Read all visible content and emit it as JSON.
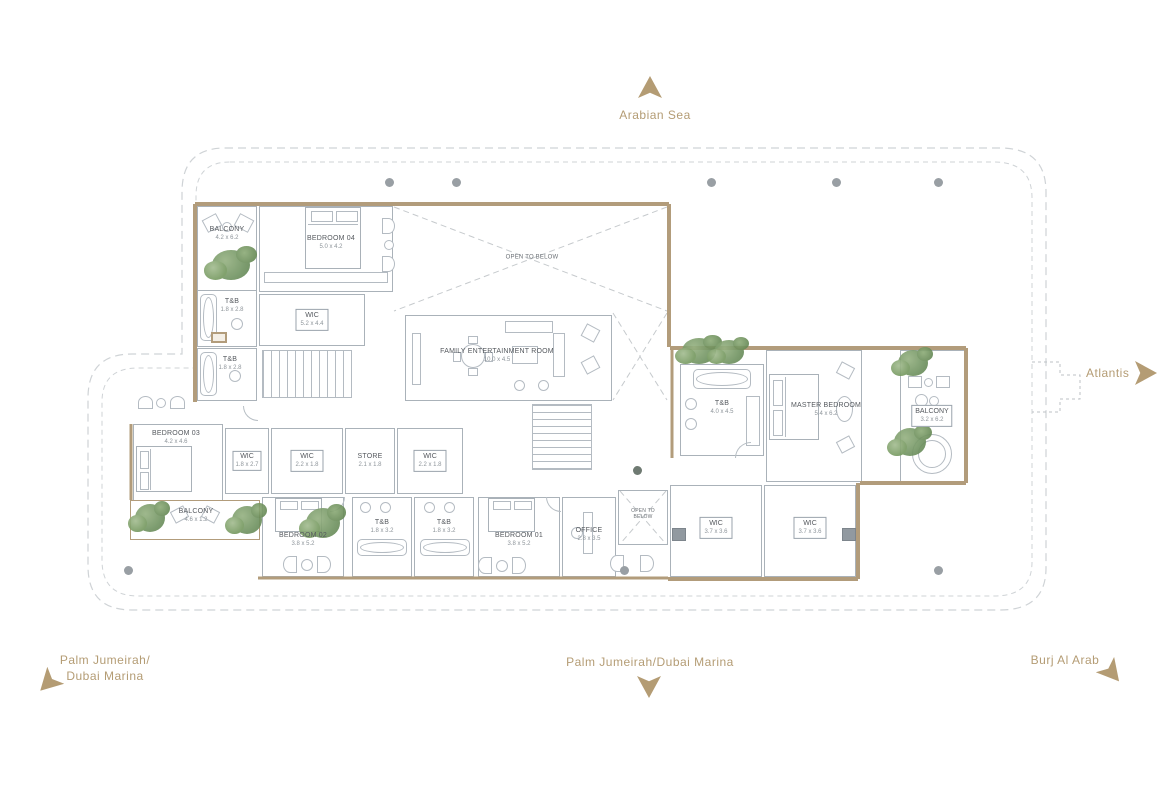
{
  "compass": {
    "north_label": "Arabian Sea",
    "east_label": "Atlantis",
    "south_label": "Palm Jumeirah/Dubai Marina",
    "southwest_label_line1": "Palm Jumeirah/",
    "southwest_label_line2": "Dubai Marina",
    "southeast_label": "Burj Al Arab"
  },
  "colors": {
    "accent": "#b49c74",
    "wall": "#b29c7b",
    "linework": "#aab2b9",
    "plant": "#6f9260"
  },
  "rooms": {
    "balcony_top_left": {
      "label": "BALCONY",
      "dims": "4.2 x 6.2"
    },
    "bedroom_04": {
      "label": "BEDROOM 04",
      "dims": "5.0 x 4.2"
    },
    "tb_upper": {
      "label": "T&B",
      "dims": "1.8 x 2.8"
    },
    "tb_lower": {
      "label": "T&B",
      "dims": "1.8 x 2.8"
    },
    "wic_bedroom_04": {
      "label": "WIC",
      "dims": "5.2 x 4.4"
    },
    "open_to_below_main": {
      "label": "OPEN TO BELOW"
    },
    "family_entertainment": {
      "label": "FAMILY ENTERTAINMENT ROOM",
      "dims": "10.0 x 4.5"
    },
    "master_tb": {
      "label": "T&B",
      "dims": "4.0 x 4.5"
    },
    "master_bedroom": {
      "label": "MASTER BEDROOM",
      "dims": "5.4 x 6.2"
    },
    "balcony_right": {
      "label": "BALCONY",
      "dims": "3.2 x 6.2"
    },
    "bedroom_03": {
      "label": "BEDROOM 03",
      "dims": "4.2 x 4.6"
    },
    "wic_bedroom_03": {
      "label": "WIC",
      "dims": "1.8 x 2.7"
    },
    "wic_middle": {
      "label": "WIC",
      "dims": "2.2 x 1.8"
    },
    "store": {
      "label": "STORE",
      "dims": "2.1 x 1.8"
    },
    "wic_bedroom_01": {
      "label": "WIC",
      "dims": "2.2 x 1.8"
    },
    "balcony_bottom_left": {
      "label": "BALCONY",
      "dims": "4.6 x 1.2"
    },
    "bedroom_02": {
      "label": "BEDROOM 02",
      "dims": "3.8 x 5.2"
    },
    "tb_bedroom_02": {
      "label": "T&B",
      "dims": "1.8 x 3.2"
    },
    "tb_bedroom_01": {
      "label": "T&B",
      "dims": "1.8 x 3.2"
    },
    "bedroom_01": {
      "label": "BEDROOM 01",
      "dims": "3.8 x 5.2"
    },
    "office": {
      "label": "OFFICE",
      "dims": "2.8 x 3.5"
    },
    "open_to_below_small": {
      "label": "OPEN TO BELOW"
    },
    "wic_master_left": {
      "label": "WIC",
      "dims": "3.7 x 3.6"
    },
    "wic_master_right": {
      "label": "WIC",
      "dims": "3.7 x 3.6"
    }
  }
}
